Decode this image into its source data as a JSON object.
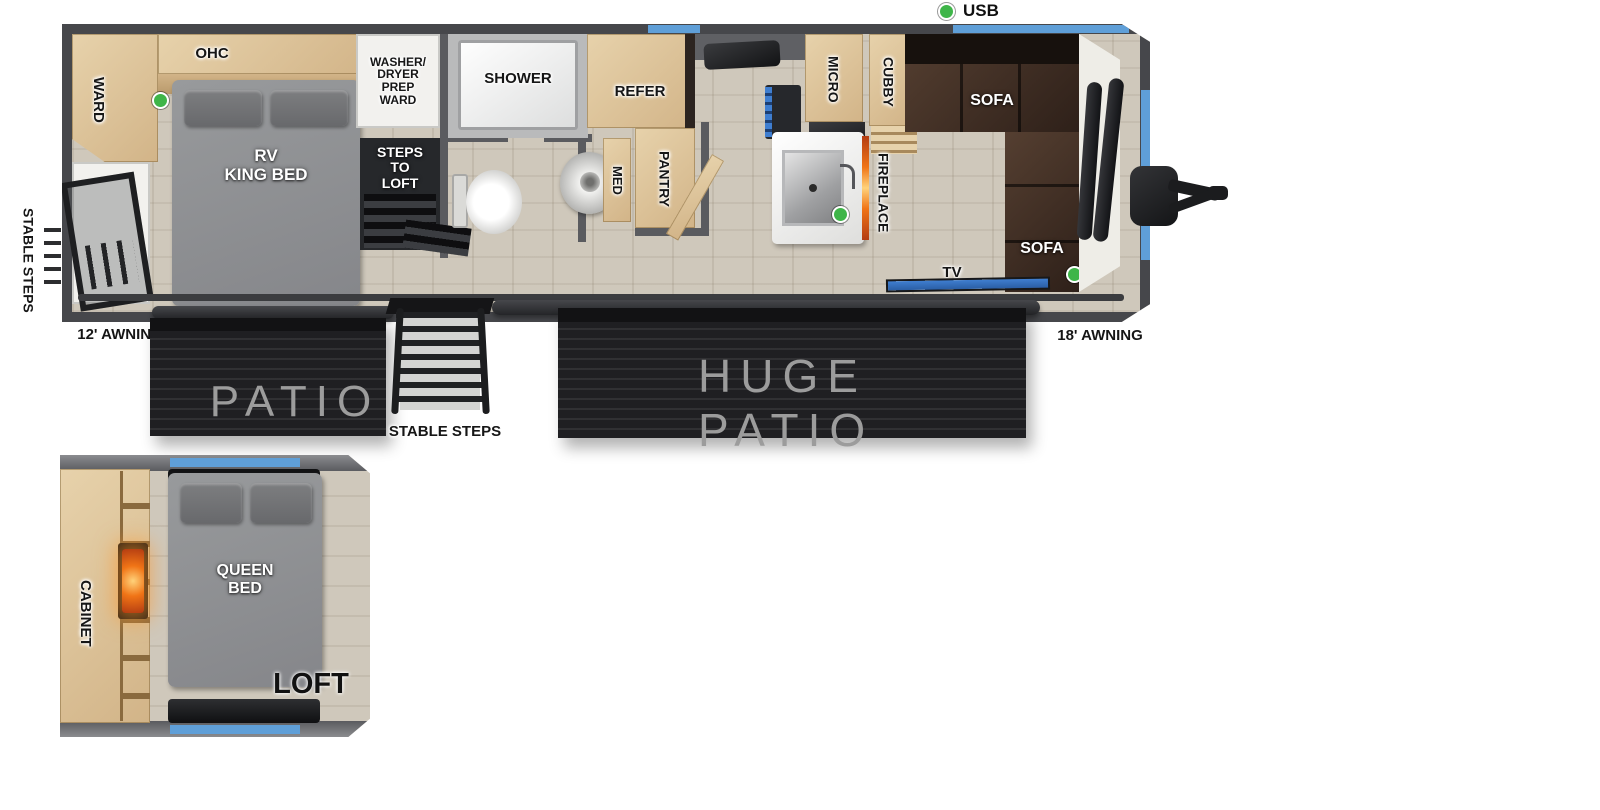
{
  "legend": {
    "usb": "USB"
  },
  "exterior": {
    "stable_steps_left": "STABLE STEPS",
    "awning_left": "12' AWNING",
    "patio_left": "PATIO",
    "stable_steps_mid": "STABLE STEPS",
    "patio_right": "HUGE PATIO",
    "awning_right": "18' AWNING"
  },
  "rooms": {
    "bedroom": {
      "ward": "WARD",
      "ohc": "OHC",
      "bed": "RV\nKING BED"
    },
    "utility": {
      "washer_dryer": "WASHER/\nDRYER\nPREP\nWARD",
      "steps": "STEPS\nTO\nLOFT"
    },
    "bathroom": {
      "shower": "SHOWER",
      "med": "MED"
    },
    "kitchen": {
      "pantry": "PANTRY",
      "refer": "REFER",
      "micro": "MICRO",
      "cubby": "CUBBY",
      "fireplace": "FIREPLACE"
    },
    "living": {
      "sofa_top": "SOFA",
      "sofa_front": "SOFA",
      "tv": "TV"
    }
  },
  "loft": {
    "cabinet": "CABINET",
    "bed": "QUEEN\nBED",
    "name": "LOFT"
  },
  "colors": {
    "wall": "#5a5b5f",
    "wallFrame": "#46474b",
    "floor": "#cfc8bb",
    "wood": "#e7d2ab",
    "woodDark": "#d2b488",
    "sofa": "#2e2019",
    "sofaHi": "#553f31",
    "bedGray": "#85868a",
    "pillow": "#68696c",
    "patio": "#1f1f22",
    "patioText": "#9c9c9c",
    "accentBlue": "#5f9fd8",
    "accentBlueLight": "#8cc6ea",
    "tvBlue": "#3f7ed0",
    "usbGreen": "#3fb549",
    "fire": "#f07416",
    "stairs": "#26282b",
    "fixture": "#f2f1ee"
  }
}
